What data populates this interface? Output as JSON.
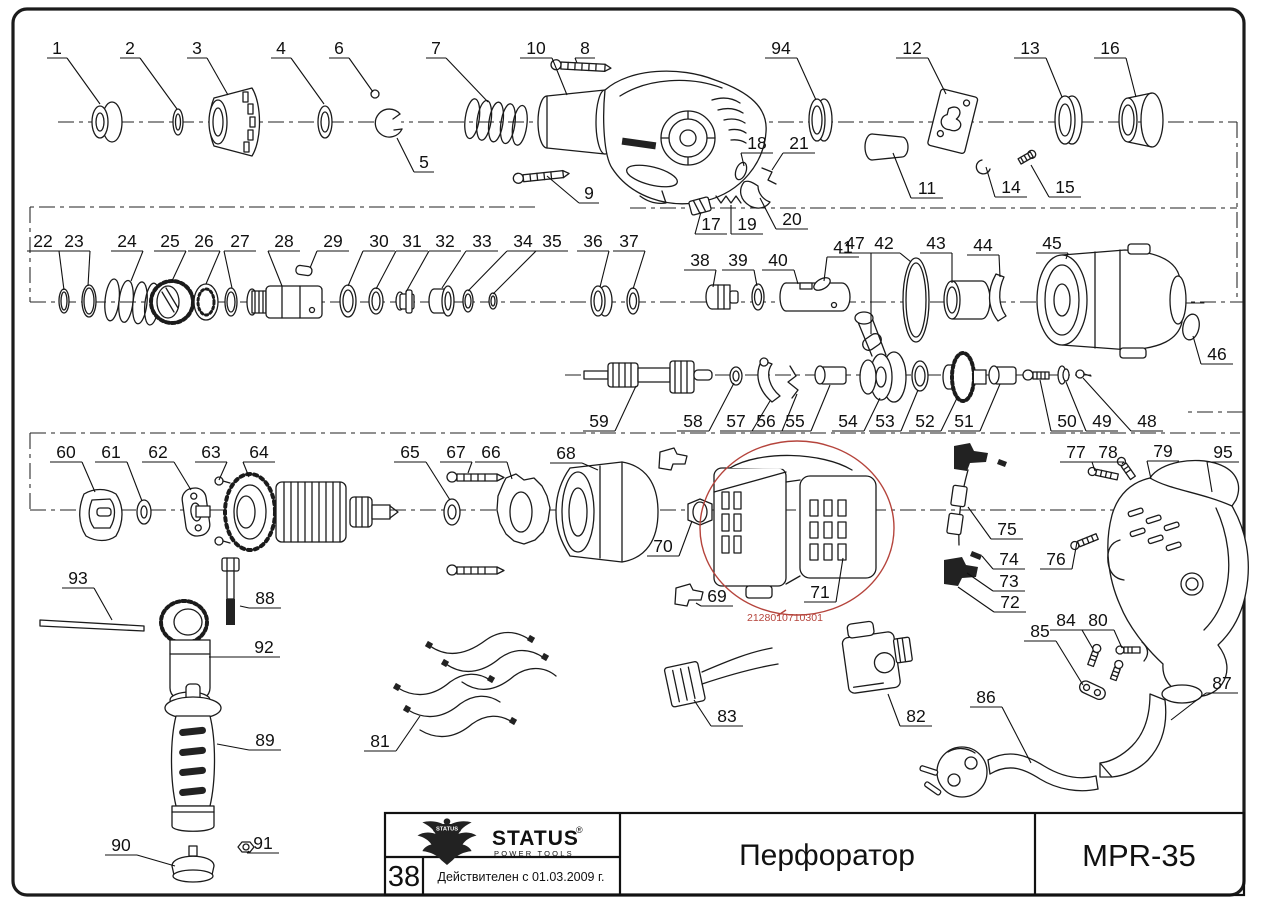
{
  "title_block": {
    "logo_brand": "STATUS",
    "logo_sub": "POWER TOOLS",
    "logo_reg_mark": "®",
    "page_number": "38",
    "validity_note": "Действителен с 01.03.2009 г.",
    "product_title": "Перфоратор",
    "model": "MPR-35"
  },
  "annotation": {
    "code": "2128010710301",
    "color": "#b5443c"
  },
  "parts": [
    {
      "n": "1",
      "lx": 57,
      "ly": 48,
      "tx": 100,
      "ty": 104
    },
    {
      "n": "2",
      "lx": 130,
      "ly": 48,
      "tx": 177,
      "ty": 109
    },
    {
      "n": "3",
      "lx": 197,
      "ly": 48,
      "tx": 228,
      "ty": 95
    },
    {
      "n": "4",
      "lx": 281,
      "ly": 48,
      "tx": 324,
      "ty": 104
    },
    {
      "n": "5",
      "lx": 424,
      "ly": 162,
      "tx": 397,
      "ty": 138
    },
    {
      "n": "6",
      "lx": 339,
      "ly": 48,
      "tx": 373,
      "ty": 92
    },
    {
      "n": "7",
      "lx": 436,
      "ly": 48,
      "tx": 488,
      "ty": 102
    },
    {
      "n": "8",
      "lx": 585,
      "ly": 48,
      "tx": 577,
      "ty": 63
    },
    {
      "n": "9",
      "lx": 589,
      "ly": 193,
      "tx": 547,
      "ty": 176
    },
    {
      "n": "10",
      "lx": 536,
      "ly": 48,
      "tx": 567,
      "ty": 95
    },
    {
      "n": "11",
      "lx": 927,
      "ly": 188,
      "tx": 893,
      "ty": 153
    },
    {
      "n": "12",
      "lx": 912,
      "ly": 48,
      "tx": 946,
      "ty": 94
    },
    {
      "n": "13",
      "lx": 1030,
      "ly": 48,
      "tx": 1062,
      "ty": 97
    },
    {
      "n": "14",
      "lx": 1011,
      "ly": 187,
      "tx": 986,
      "ty": 167
    },
    {
      "n": "15",
      "lx": 1065,
      "ly": 187,
      "tx": 1031,
      "ty": 165
    },
    {
      "n": "16",
      "lx": 1110,
      "ly": 48,
      "tx": 1136,
      "ty": 97
    },
    {
      "n": "17",
      "lx": 711,
      "ly": 224,
      "tx": 701,
      "ty": 212
    },
    {
      "n": "18",
      "lx": 757,
      "ly": 143,
      "tx": 744,
      "ty": 166
    },
    {
      "n": "19",
      "lx": 747,
      "ly": 224,
      "tx": 731,
      "ty": 205
    },
    {
      "n": "20",
      "lx": 792,
      "ly": 219,
      "tx": 760,
      "ty": 198
    },
    {
      "n": "21",
      "lx": 799,
      "ly": 143,
      "tx": 772,
      "ty": 170
    },
    {
      "n": "22",
      "lx": 43,
      "ly": 241,
      "tx": 64,
      "ty": 290
    },
    {
      "n": "23",
      "lx": 74,
      "ly": 241,
      "tx": 88,
      "ty": 286
    },
    {
      "n": "24",
      "lx": 127,
      "ly": 241,
      "tx": 131,
      "ty": 281
    },
    {
      "n": "25",
      "lx": 170,
      "ly": 241,
      "tx": 172,
      "ty": 281
    },
    {
      "n": "26",
      "lx": 204,
      "ly": 241,
      "tx": 206,
      "ty": 284
    },
    {
      "n": "27",
      "lx": 240,
      "ly": 241,
      "tx": 232,
      "ty": 288
    },
    {
      "n": "28",
      "lx": 284,
      "ly": 241,
      "tx": 282,
      "ty": 286
    },
    {
      "n": "29",
      "lx": 333,
      "ly": 241,
      "tx": 310,
      "ty": 268
    },
    {
      "n": "30",
      "lx": 379,
      "ly": 241,
      "tx": 348,
      "ty": 286
    },
    {
      "n": "31",
      "lx": 412,
      "ly": 241,
      "tx": 376,
      "ty": 289
    },
    {
      "n": "32",
      "lx": 445,
      "ly": 241,
      "tx": 406,
      "ty": 292
    },
    {
      "n": "33",
      "lx": 482,
      "ly": 241,
      "tx": 442,
      "ty": 288
    },
    {
      "n": "34",
      "lx": 523,
      "ly": 241,
      "tx": 468,
      "ty": 291
    },
    {
      "n": "35",
      "lx": 552,
      "ly": 241,
      "tx": 493,
      "ty": 294
    },
    {
      "n": "36",
      "lx": 593,
      "ly": 241,
      "tx": 600,
      "ty": 287
    },
    {
      "n": "37",
      "lx": 629,
      "ly": 241,
      "tx": 633,
      "ty": 289
    },
    {
      "n": "38",
      "lx": 700,
      "ly": 260,
      "tx": 713,
      "ty": 287
    },
    {
      "n": "39",
      "lx": 738,
      "ly": 260,
      "tx": 757,
      "ty": 286
    },
    {
      "n": "40",
      "lx": 778,
      "ly": 260,
      "tx": 798,
      "ty": 284
    },
    {
      "n": "41",
      "lx": 843,
      "ly": 247,
      "tx": 824,
      "ty": 281
    },
    {
      "n": "42",
      "lx": 884,
      "ly": 243,
      "tx": 911,
      "ty": 262
    },
    {
      "n": "43",
      "lx": 936,
      "ly": 243,
      "tx": 952,
      "ty": 283
    },
    {
      "n": "44",
      "lx": 983,
      "ly": 245,
      "tx": 1000,
      "ty": 277
    },
    {
      "n": "45",
      "lx": 1052,
      "ly": 243,
      "tx": 1066,
      "ty": 259
    },
    {
      "n": "46",
      "lx": 1217,
      "ly": 354,
      "tx": 1193,
      "ty": 336
    },
    {
      "n": "47",
      "lx": 855,
      "ly": 243,
      "tx": 871,
      "ty": 334
    },
    {
      "n": "48",
      "lx": 1147,
      "ly": 421,
      "tx": 1083,
      "ty": 378
    },
    {
      "n": "49",
      "lx": 1102,
      "ly": 421,
      "tx": 1066,
      "ty": 382
    },
    {
      "n": "50",
      "lx": 1067,
      "ly": 421,
      "tx": 1040,
      "ty": 380
    },
    {
      "n": "51",
      "lx": 964,
      "ly": 421,
      "tx": 1000,
      "ty": 384
    },
    {
      "n": "52",
      "lx": 925,
      "ly": 421,
      "tx": 958,
      "ty": 396
    },
    {
      "n": "53",
      "lx": 885,
      "ly": 421,
      "tx": 918,
      "ty": 390
    },
    {
      "n": "54",
      "lx": 848,
      "ly": 421,
      "tx": 880,
      "ty": 398
    },
    {
      "n": "55",
      "lx": 795,
      "ly": 421,
      "tx": 830,
      "ty": 385
    },
    {
      "n": "56",
      "lx": 766,
      "ly": 421,
      "tx": 797,
      "ty": 394
    },
    {
      "n": "57",
      "lx": 736,
      "ly": 421,
      "tx": 770,
      "ty": 401
    },
    {
      "n": "58",
      "lx": 693,
      "ly": 421,
      "tx": 734,
      "ty": 383
    },
    {
      "n": "59",
      "lx": 599,
      "ly": 421,
      "tx": 636,
      "ty": 386
    },
    {
      "n": "60",
      "lx": 66,
      "ly": 452,
      "tx": 95,
      "ty": 492
    },
    {
      "n": "61",
      "lx": 111,
      "ly": 452,
      "tx": 142,
      "ty": 501
    },
    {
      "n": "62",
      "lx": 158,
      "ly": 452,
      "tx": 191,
      "ty": 490
    },
    {
      "n": "63",
      "lx": 211,
      "ly": 452,
      "tx": 219,
      "ty": 480
    },
    {
      "n": "64",
      "lx": 259,
      "ly": 452,
      "tx": 249,
      "ty": 477
    },
    {
      "n": "65",
      "lx": 410,
      "ly": 452,
      "tx": 450,
      "ty": 500
    },
    {
      "n": "66",
      "lx": 491,
      "ly": 452,
      "tx": 512,
      "ty": 479
    },
    {
      "n": "67",
      "lx": 456,
      "ly": 452,
      "tx": 468,
      "ty": 473
    },
    {
      "n": "68",
      "lx": 566,
      "ly": 453,
      "tx": 598,
      "ty": 470
    },
    {
      "n": "69",
      "lx": 717,
      "ly": 596,
      "tx": 696,
      "ty": 603
    },
    {
      "n": "70",
      "lx": 663,
      "ly": 546,
      "tx": 692,
      "ty": 521
    },
    {
      "n": "71",
      "lx": 820,
      "ly": 592,
      "tx": 843,
      "ty": 558
    },
    {
      "n": "72",
      "lx": 1010,
      "ly": 602,
      "tx": 958,
      "ty": 587
    },
    {
      "n": "73",
      "lx": 1009,
      "ly": 581,
      "tx": 967,
      "ty": 573
    },
    {
      "n": "74",
      "lx": 1009,
      "ly": 559,
      "tx": 982,
      "ty": 556
    },
    {
      "n": "75",
      "lx": 1007,
      "ly": 529,
      "tx": 968,
      "ty": 507
    },
    {
      "n": "76",
      "lx": 1056,
      "ly": 559,
      "tx": 1077,
      "ty": 542
    },
    {
      "n": "77",
      "lx": 1076,
      "ly": 452,
      "tx": 1095,
      "ty": 471
    },
    {
      "n": "78",
      "lx": 1108,
      "ly": 452,
      "tx": 1122,
      "ty": 464
    },
    {
      "n": "79",
      "lx": 1163,
      "ly": 451,
      "tx": 1151,
      "ty": 479
    },
    {
      "n": "80",
      "lx": 1098,
      "ly": 620,
      "tx": 1122,
      "ty": 648
    },
    {
      "n": "81",
      "lx": 380,
      "ly": 741,
      "tx": 420,
      "ty": 716
    },
    {
      "n": "82",
      "lx": 916,
      "ly": 716,
      "tx": 888,
      "ty": 694
    },
    {
      "n": "83",
      "lx": 727,
      "ly": 716,
      "tx": 694,
      "ty": 700
    },
    {
      "n": "84",
      "lx": 1066,
      "ly": 620,
      "tx": 1093,
      "ty": 649
    },
    {
      "n": "85",
      "lx": 1040,
      "ly": 631,
      "tx": 1083,
      "ty": 685
    },
    {
      "n": "86",
      "lx": 986,
      "ly": 697,
      "tx": 1031,
      "ty": 763
    },
    {
      "n": "87",
      "lx": 1222,
      "ly": 683,
      "tx": 1171,
      "ty": 720
    },
    {
      "n": "88",
      "lx": 265,
      "ly": 598,
      "tx": 240,
      "ty": 606
    },
    {
      "n": "89",
      "lx": 265,
      "ly": 740,
      "tx": 217,
      "ty": 744
    },
    {
      "n": "90",
      "lx": 121,
      "ly": 845,
      "tx": 175,
      "ty": 866
    },
    {
      "n": "91",
      "lx": 263,
      "ly": 843,
      "tx": 249,
      "ty": 851
    },
    {
      "n": "92",
      "lx": 264,
      "ly": 647,
      "tx": 209,
      "ty": 657
    },
    {
      "n": "93",
      "lx": 78,
      "ly": 578,
      "tx": 112,
      "ty": 620
    },
    {
      "n": "94",
      "lx": 781,
      "ly": 48,
      "tx": 816,
      "ty": 100
    },
    {
      "n": "95",
      "lx": 1223,
      "ly": 452,
      "tx": 1212,
      "ty": 492
    }
  ]
}
